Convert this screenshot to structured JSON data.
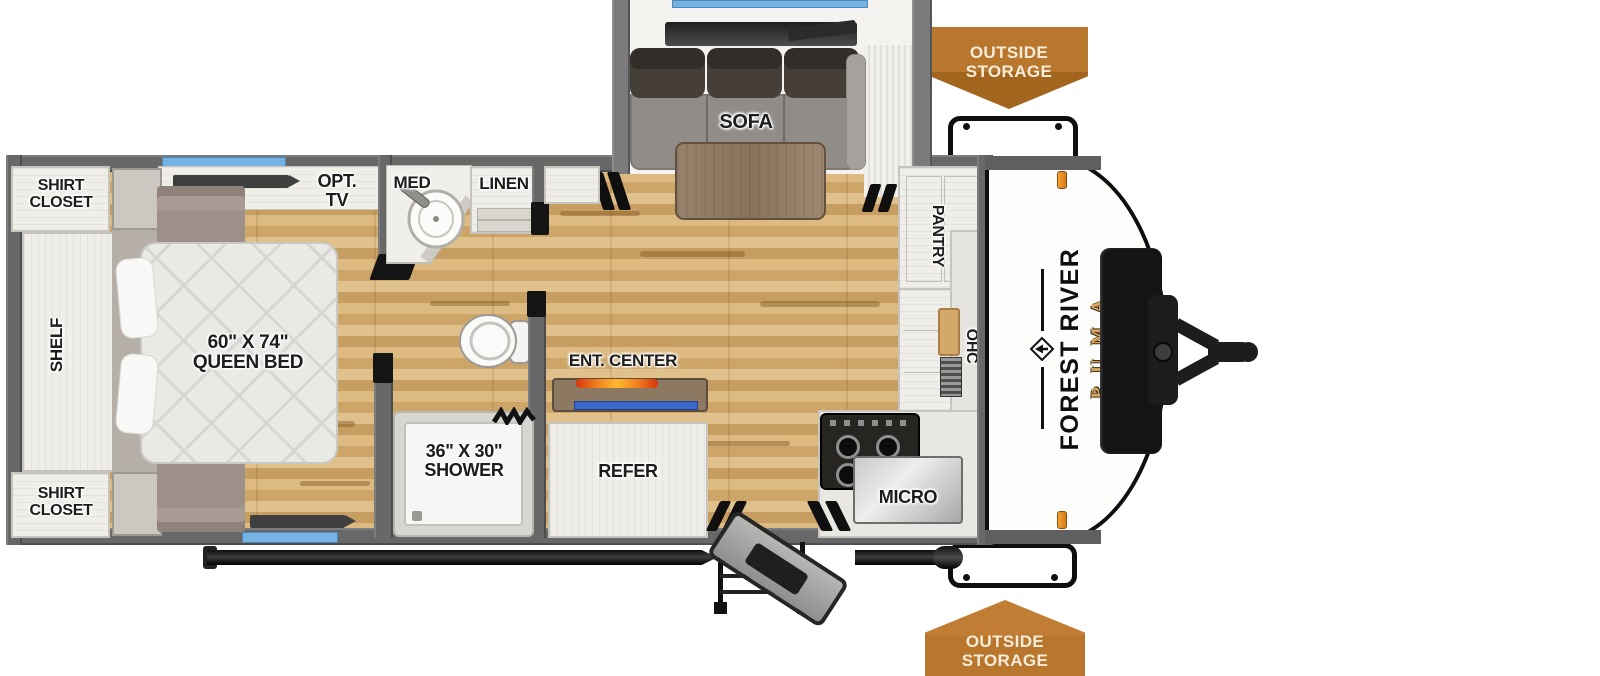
{
  "title": "Forest River Puma travel trailer floorplan",
  "brand": {
    "make": "FOREST RIVER",
    "model": "PUMA"
  },
  "labels": {
    "shirt_closet_top": {
      "line1": "SHIRT",
      "line2": "CLOSET"
    },
    "shirt_closet_bottom": {
      "line1": "SHIRT",
      "line2": "CLOSET"
    },
    "shelf": "SHELF",
    "queen_bed": {
      "line1": "60\" X 74\"",
      "line2": "QUEEN BED"
    },
    "opt_tv": {
      "line1": "OPT.",
      "line2": "TV"
    },
    "med": "MED",
    "linen": "LINEN",
    "shower": {
      "line1": "36\" X 30\"",
      "line2": "SHOWER"
    },
    "ent_center": "ENT. CENTER",
    "refer": "REFER",
    "sofa": "SOFA",
    "pantry": "PANTRY",
    "ohc": "OHC",
    "micro": "MICRO",
    "outside_storage_top": {
      "line1": "OUTSIDE",
      "line2": "STORAGE"
    },
    "outside_storage_bottom": {
      "line1": "OUTSIDE",
      "line2": "STORAGE"
    }
  },
  "colors": {
    "badge_orange": "#B9772E",
    "window_blue": "#74B3E3",
    "puma_gold": "#D9A75C",
    "ent_shelf_blue": "#3B67C9",
    "fireplace_orange": "#F07F1F",
    "wall_gray": "#686868",
    "floor_wood": "#D8B57C"
  }
}
